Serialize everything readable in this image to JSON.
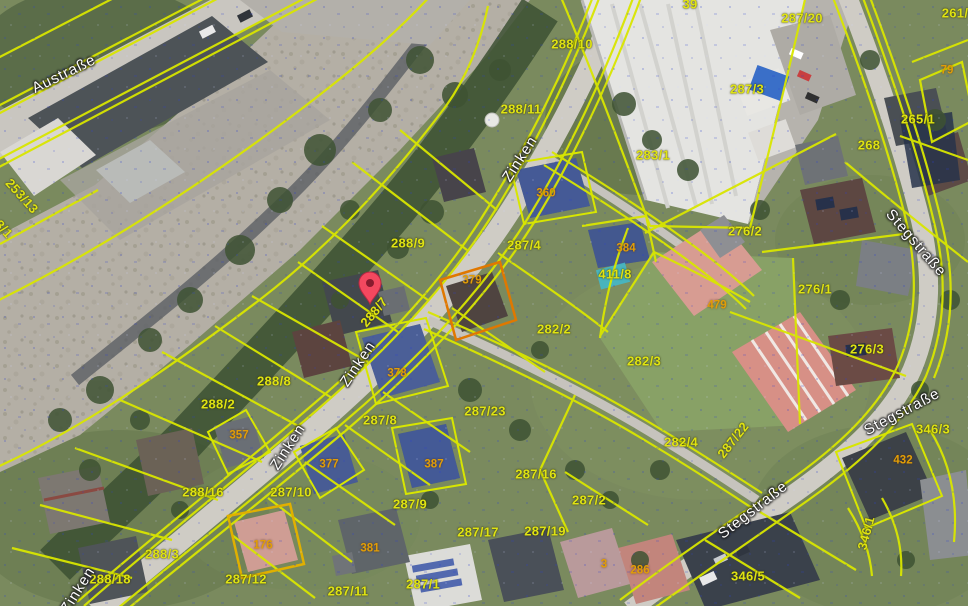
{
  "map": {
    "colors": {
      "boundary_yellow": "#d9e600",
      "parcel_text_yellow": "#dfe313",
      "building_text_orange": "#e29d06",
      "street_text": "#fdfdfd",
      "pin_red": "#f4485f",
      "selection_blue": "#3c5ec6"
    },
    "street_labels": [
      {
        "t": "Austraße",
        "x": 64,
        "y": 74,
        "r": -26
      },
      {
        "t": "Zinken",
        "x": 520,
        "y": 159,
        "r": -57
      },
      {
        "t": "Zinken",
        "x": 358,
        "y": 364,
        "r": -56
      },
      {
        "t": "Zinken",
        "x": 288,
        "y": 447,
        "r": -57
      },
      {
        "t": "Zinken",
        "x": 78,
        "y": 590,
        "r": -58
      },
      {
        "t": "Stegstraße",
        "x": 916,
        "y": 243,
        "r": 49
      },
      {
        "t": "Stegstraße",
        "x": 902,
        "y": 412,
        "r": -28
      },
      {
        "t": "Stegstraße",
        "x": 753,
        "y": 510,
        "r": -38
      }
    ],
    "parcel_labels": [
      {
        "t": "287/20",
        "x": 802,
        "y": 18
      },
      {
        "t": "261/",
        "x": 955,
        "y": 13
      },
      {
        "t": "39",
        "x": 690,
        "y": 4
      },
      {
        "t": "288/10",
        "x": 572,
        "y": 44
      },
      {
        "t": "288/11",
        "x": 521,
        "y": 109
      },
      {
        "t": "283/1",
        "x": 653,
        "y": 155
      },
      {
        "t": "287/3",
        "x": 747,
        "y": 89
      },
      {
        "t": "265/1",
        "x": 918,
        "y": 119
      },
      {
        "t": "268",
        "x": 869,
        "y": 145
      },
      {
        "t": "253/13",
        "x": 22,
        "y": 196,
        "r": 48
      },
      {
        "t": "3/1",
        "x": 4,
        "y": 229,
        "r": 48
      },
      {
        "t": "288/9",
        "x": 408,
        "y": 243
      },
      {
        "t": "287/4",
        "x": 524,
        "y": 245
      },
      {
        "t": "276/2",
        "x": 745,
        "y": 231
      },
      {
        "t": "276/1",
        "x": 815,
        "y": 289
      },
      {
        "t": "288/7",
        "x": 374,
        "y": 312,
        "r": -50
      },
      {
        "t": "282/2",
        "x": 554,
        "y": 329
      },
      {
        "t": "411/8",
        "x": 615,
        "y": 274
      },
      {
        "t": "282/3",
        "x": 644,
        "y": 361
      },
      {
        "t": "276/3",
        "x": 867,
        "y": 349
      },
      {
        "t": "282/4",
        "x": 681,
        "y": 442
      },
      {
        "t": "287/22",
        "x": 733,
        "y": 440,
        "r": -52
      },
      {
        "t": "346/3",
        "x": 933,
        "y": 429
      },
      {
        "t": "288/8",
        "x": 274,
        "y": 381
      },
      {
        "t": "288/2",
        "x": 218,
        "y": 404
      },
      {
        "t": "287/8",
        "x": 380,
        "y": 420
      },
      {
        "t": "287/23",
        "x": 485,
        "y": 411
      },
      {
        "t": "287/16",
        "x": 536,
        "y": 474
      },
      {
        "t": "288/16",
        "x": 203,
        "y": 492
      },
      {
        "t": "287/10",
        "x": 291,
        "y": 492
      },
      {
        "t": "287/9",
        "x": 410,
        "y": 504
      },
      {
        "t": "287/17",
        "x": 478,
        "y": 532
      },
      {
        "t": "287/19",
        "x": 545,
        "y": 531
      },
      {
        "t": "287/2",
        "x": 589,
        "y": 500
      },
      {
        "t": "288/3",
        "x": 162,
        "y": 554
      },
      {
        "t": "288/18",
        "x": 110,
        "y": 579
      },
      {
        "t": "287/12",
        "x": 246,
        "y": 579
      },
      {
        "t": "287/11",
        "x": 348,
        "y": 591
      },
      {
        "t": "287/1",
        "x": 423,
        "y": 584
      },
      {
        "t": "346/5",
        "x": 748,
        "y": 576
      },
      {
        "t": "346/1",
        "x": 866,
        "y": 533,
        "r": -75
      }
    ],
    "building_labels": [
      {
        "t": "360",
        "x": 546,
        "y": 194
      },
      {
        "t": "384",
        "x": 626,
        "y": 249
      },
      {
        "t": "379",
        "x": 472,
        "y": 281
      },
      {
        "t": "378",
        "x": 397,
        "y": 374
      },
      {
        "t": "377",
        "x": 329,
        "y": 465
      },
      {
        "t": "357",
        "x": 239,
        "y": 436
      },
      {
        "t": "387",
        "x": 434,
        "y": 465
      },
      {
        "t": "381",
        "x": 370,
        "y": 549
      },
      {
        "t": "176",
        "x": 263,
        "y": 546
      },
      {
        "t": "479",
        "x": 717,
        "y": 306
      },
      {
        "t": "432",
        "x": 903,
        "y": 461
      },
      {
        "t": "79",
        "x": 947,
        "y": 71
      },
      {
        "t": "3",
        "x": 604,
        "y": 565
      },
      {
        "t": "286",
        "x": 640,
        "y": 571
      }
    ],
    "pin": {
      "x": 370,
      "y": 304
    }
  }
}
